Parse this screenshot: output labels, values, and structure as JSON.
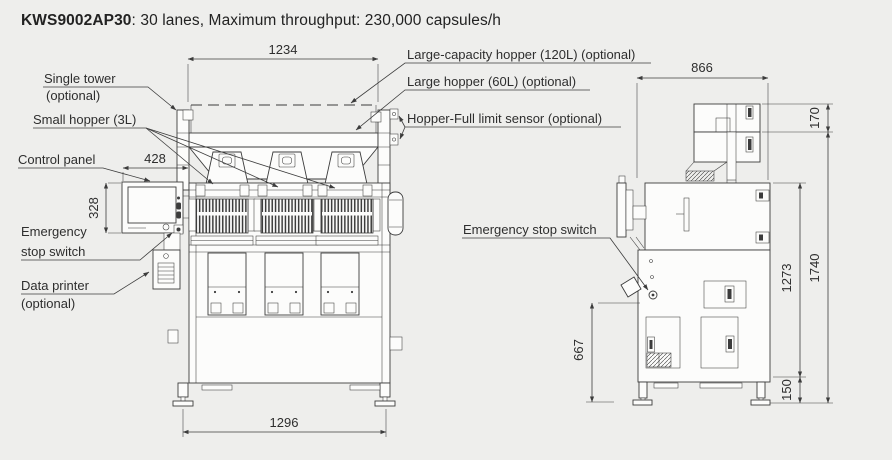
{
  "title": {
    "model": "KWS9002AP30",
    "specs": ": 30 lanes, Maximum throughput: 230,000 capsules/h"
  },
  "front_view": {
    "callouts": {
      "single_tower": {
        "line1": "Single tower",
        "line2": "(optional)"
      },
      "small_hopper": "Small hopper (3L)",
      "control_panel": "Control panel",
      "emergency_stop": {
        "line1": "Emergency",
        "line2": "stop switch"
      },
      "data_printer": {
        "line1": "Data printer",
        "line2": "(optional)"
      },
      "large_capacity_hopper": "Large-capacity hopper (120L) (optional)",
      "large_hopper": "Large hopper (60L) (optional)",
      "hopper_full_sensor": "Hopper-Full limit sensor (optional)"
    },
    "dimensions": {
      "hopper_width_mm": "1234",
      "base_width_mm": "1296",
      "control_panel_width_mm": "428",
      "control_panel_height_mm": "328"
    }
  },
  "side_view": {
    "callouts": {
      "emergency_stop": "Emergency stop switch"
    },
    "dimensions": {
      "depth_mm": "866",
      "tower_section_mm": "170",
      "total_height_mm": "1740",
      "upper_height_mm": "1273",
      "base_height_mm": "150",
      "stop_switch_height_mm": "667"
    }
  },
  "colors": {
    "background": "#eeeeec",
    "line": "#3c3c3c",
    "text": "#2e2e2e",
    "panel": "#fcfcfb"
  }
}
